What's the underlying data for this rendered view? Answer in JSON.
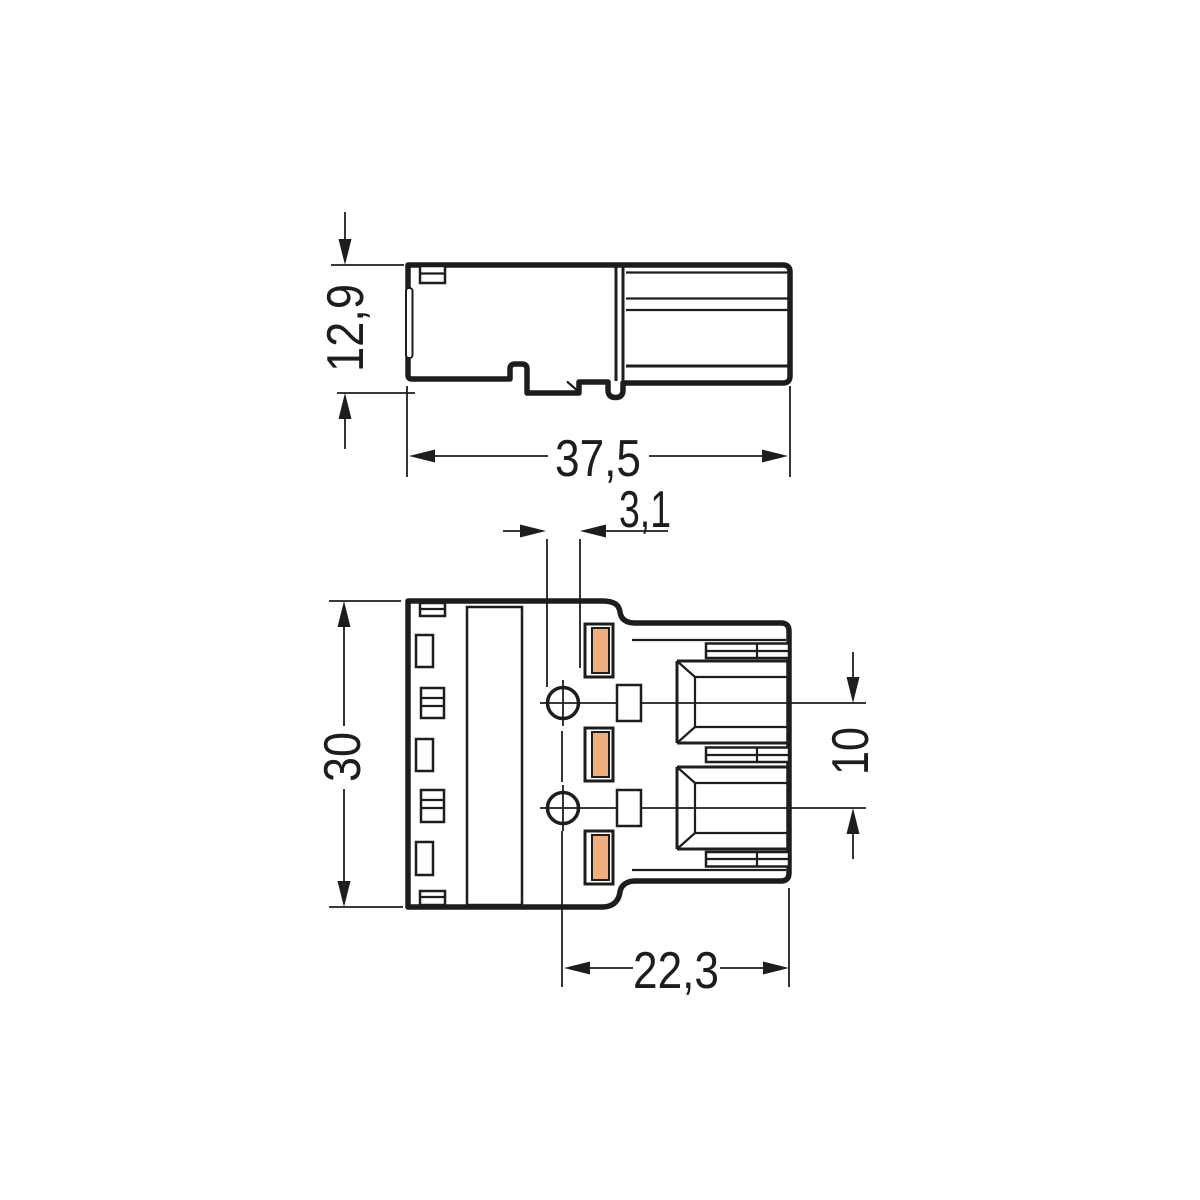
{
  "drawing": {
    "side_view": {
      "height_label": "12,9",
      "width_label": "37,5"
    },
    "front_view": {
      "slot_width_label": "3,1",
      "height_label": "30",
      "pitch_label": "10",
      "width_label": "22,3"
    },
    "colors": {
      "line": "#1d1d1b",
      "contact_fill": "#F0AD7D",
      "background": "#FFFFFF"
    }
  }
}
